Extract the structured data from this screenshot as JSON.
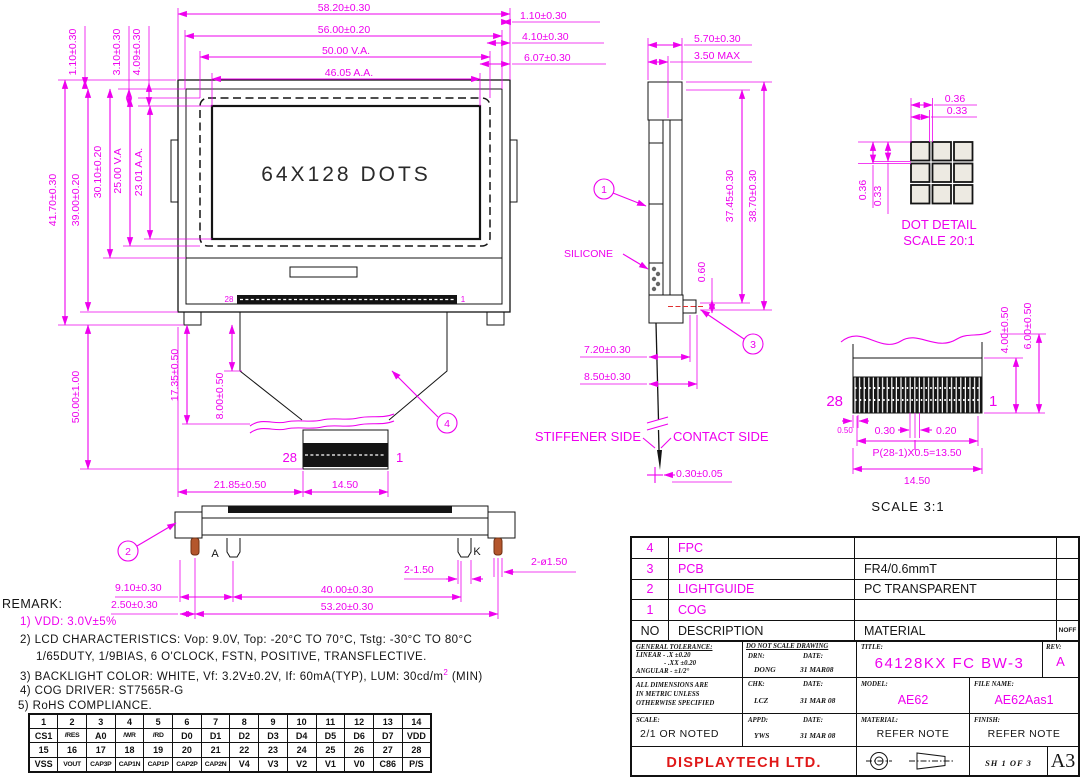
{
  "colors": {
    "dim": "#ee00ee",
    "line": "#141414",
    "accent_red": "#e01818",
    "pin_copper": "#b4562c"
  },
  "front": {
    "screen": "64X128 DOTS",
    "top": [
      "58.20±0.30",
      "56.00±0.20",
      "50.00  V.A.",
      "46.05  A.A."
    ],
    "topRight": [
      "1.10±0.30",
      "4.10±0.30",
      "6.07±0.30"
    ],
    "topLeft": [
      "1.10±0.30",
      "3.10±0.30",
      "4.09±0.30"
    ],
    "left": [
      "41.70±0.30",
      "39.00±0.20",
      "30.10±0.20",
      "25.00 V.A",
      "23.01 A.A."
    ],
    "tailHeight": "50.00±1.00",
    "tail": [
      "17.35±0.50",
      "8.00±0.50"
    ],
    "bottom": [
      "21.85±0.50",
      "14.50"
    ],
    "bondLeft": "28",
    "bondRight": "1",
    "fpcLeft": "28",
    "fpcRight": "1",
    "callout": "4"
  },
  "side": {
    "top": [
      "5.70±0.30",
      "3.50 MAX"
    ],
    "height": [
      "37.45±0.30",
      "38.70±0.30"
    ],
    "bump": "0.60",
    "silicone": "SILICONE",
    "lower": [
      "7.20±0.30",
      "8.50±0.30"
    ],
    "stiffener": "STIFFENER SIDE",
    "contact": "CONTACT SIDE",
    "tip": "0.30±0.05",
    "callout1": "1",
    "callout3": "3"
  },
  "dot": {
    "h": [
      "0.36",
      "0.33"
    ],
    "v": [
      "0.36",
      "0.33"
    ],
    "title": "DOT DETAIL",
    "scale": "SCALE 20:1"
  },
  "fpc": {
    "left": "28",
    "right": "1",
    "side": [
      "4.00±0.50",
      "6.00±0.50"
    ],
    "margin": "0.50",
    "pinw": "0.30",
    "gap": "0.20",
    "pitch": "P(28-1)X0.5=13.50",
    "width": "14.50",
    "scale": "SCALE  3:1"
  },
  "bottomv": {
    "callout": "2",
    "a": "A",
    "k": "K",
    "pin": "2-1.50",
    "hole": "2-ø1.50",
    "d1": "9.10±0.30",
    "d2": "40.00±0.30",
    "d3": "2.50±0.30",
    "d4": "53.20±0.30"
  },
  "remark": {
    "title": "REMARK:",
    "l1": "1)  VDD: 3.0V±5%",
    "l2": "2)  LCD  CHARACTERISTICS:   Vop: 9.0V,   Top: -20°C  TO  70°C,   Tstg: -30°C  TO  80°C",
    "l2b": "1/65DUTY,  1/9BIAS,  6  O'CLOCK,  FSTN,  POSITIVE,  TRANSFLECTIVE.",
    "l3a": "3)  BACKLIGHT  COLOR:   WHITE,  Vf: 3.2V±0.2V,  If: 60mA(TYP),  LUM: 30cd/m",
    "l3sup": "2",
    "l3b": " (MIN)",
    "l4": "4)  COG  DRIVER:   ST7565R-G",
    "l5": "5) RoHS  COMPLIANCE."
  },
  "pins": {
    "r1": [
      "1",
      "2",
      "3",
      "4",
      "5",
      "6",
      "7",
      "8",
      "9",
      "10",
      "11",
      "12",
      "13",
      "14"
    ],
    "r2": [
      "CS1",
      "/RES",
      "A0",
      "/WR",
      "/RD",
      "D0",
      "D1",
      "D2",
      "D3",
      "D4",
      "D5",
      "D6",
      "D7",
      "VDD"
    ],
    "r3": [
      "15",
      "16",
      "17",
      "18",
      "19",
      "20",
      "21",
      "22",
      "23",
      "24",
      "25",
      "26",
      "27",
      "28"
    ],
    "r4": [
      "VSS",
      "VOUT",
      "CAP3P",
      "CAP1N",
      "CAP1P",
      "CAP2P",
      "CAP2N",
      "V4",
      "V3",
      "V2",
      "V1",
      "V0",
      "C86",
      "P/S"
    ]
  },
  "bom": {
    "r4no": "4",
    "r4desc": "FPC",
    "r4mat": "",
    "r3no": "3",
    "r3desc": "PCB",
    "r3mat": "FR4/0.6mmT",
    "r2no": "2",
    "r2desc": "LIGHTGUIDE",
    "r2mat": "PC  TRANSPARENT",
    "r1no": "1",
    "r1desc": "COG",
    "r1mat": "",
    "hno": "NO",
    "hdesc": "DESCRIPTION",
    "hmat": "MATERIAL",
    "hqty": "NOFF"
  },
  "title": {
    "tol0": "GENERAL TOLERANCE:",
    "tol1": "LINEAR - .X  ±0.20",
    "tol2": "- .XX ±0.20",
    "tol3": "ANGULAR - ±1/2°",
    "dns": "DO NOT SCALE DRAWING",
    "drn": "DRN:",
    "drnv": "DONG",
    "date1": "DATE:",
    "datev1": "31 MAR08",
    "chk": "CHK:",
    "chkv": "LCZ",
    "date2": "DATE:",
    "datev2": "31 MAR 08",
    "appd": "APPD:",
    "appdv": "YWS",
    "date3": "DATE:",
    "datev3": "31 MAR 08",
    "met1": "ALL DIMENSIONS ARE",
    "met2": "IN METRIC UNLESS",
    "met3": "OTHERWISE SPECIFIED",
    "scale": "SCALE:",
    "scalev": "2/1 OR NOTED",
    "ttl": "TITLE:",
    "ttlv": "64128KX FC BW-3",
    "rev": "REV:",
    "revv": "A",
    "model": "MODEL:",
    "modelv": "AE62",
    "file": "FILE NAME:",
    "filev": "AE62Aas1",
    "mat": "MATERIAL:",
    "matv": "REFER NOTE",
    "fin": "FINISH:",
    "finv": "REFER NOTE",
    "co": "DISPLAYTECH  LTD.",
    "sh": "SH  1  OF  3",
    "paper": "A3"
  }
}
